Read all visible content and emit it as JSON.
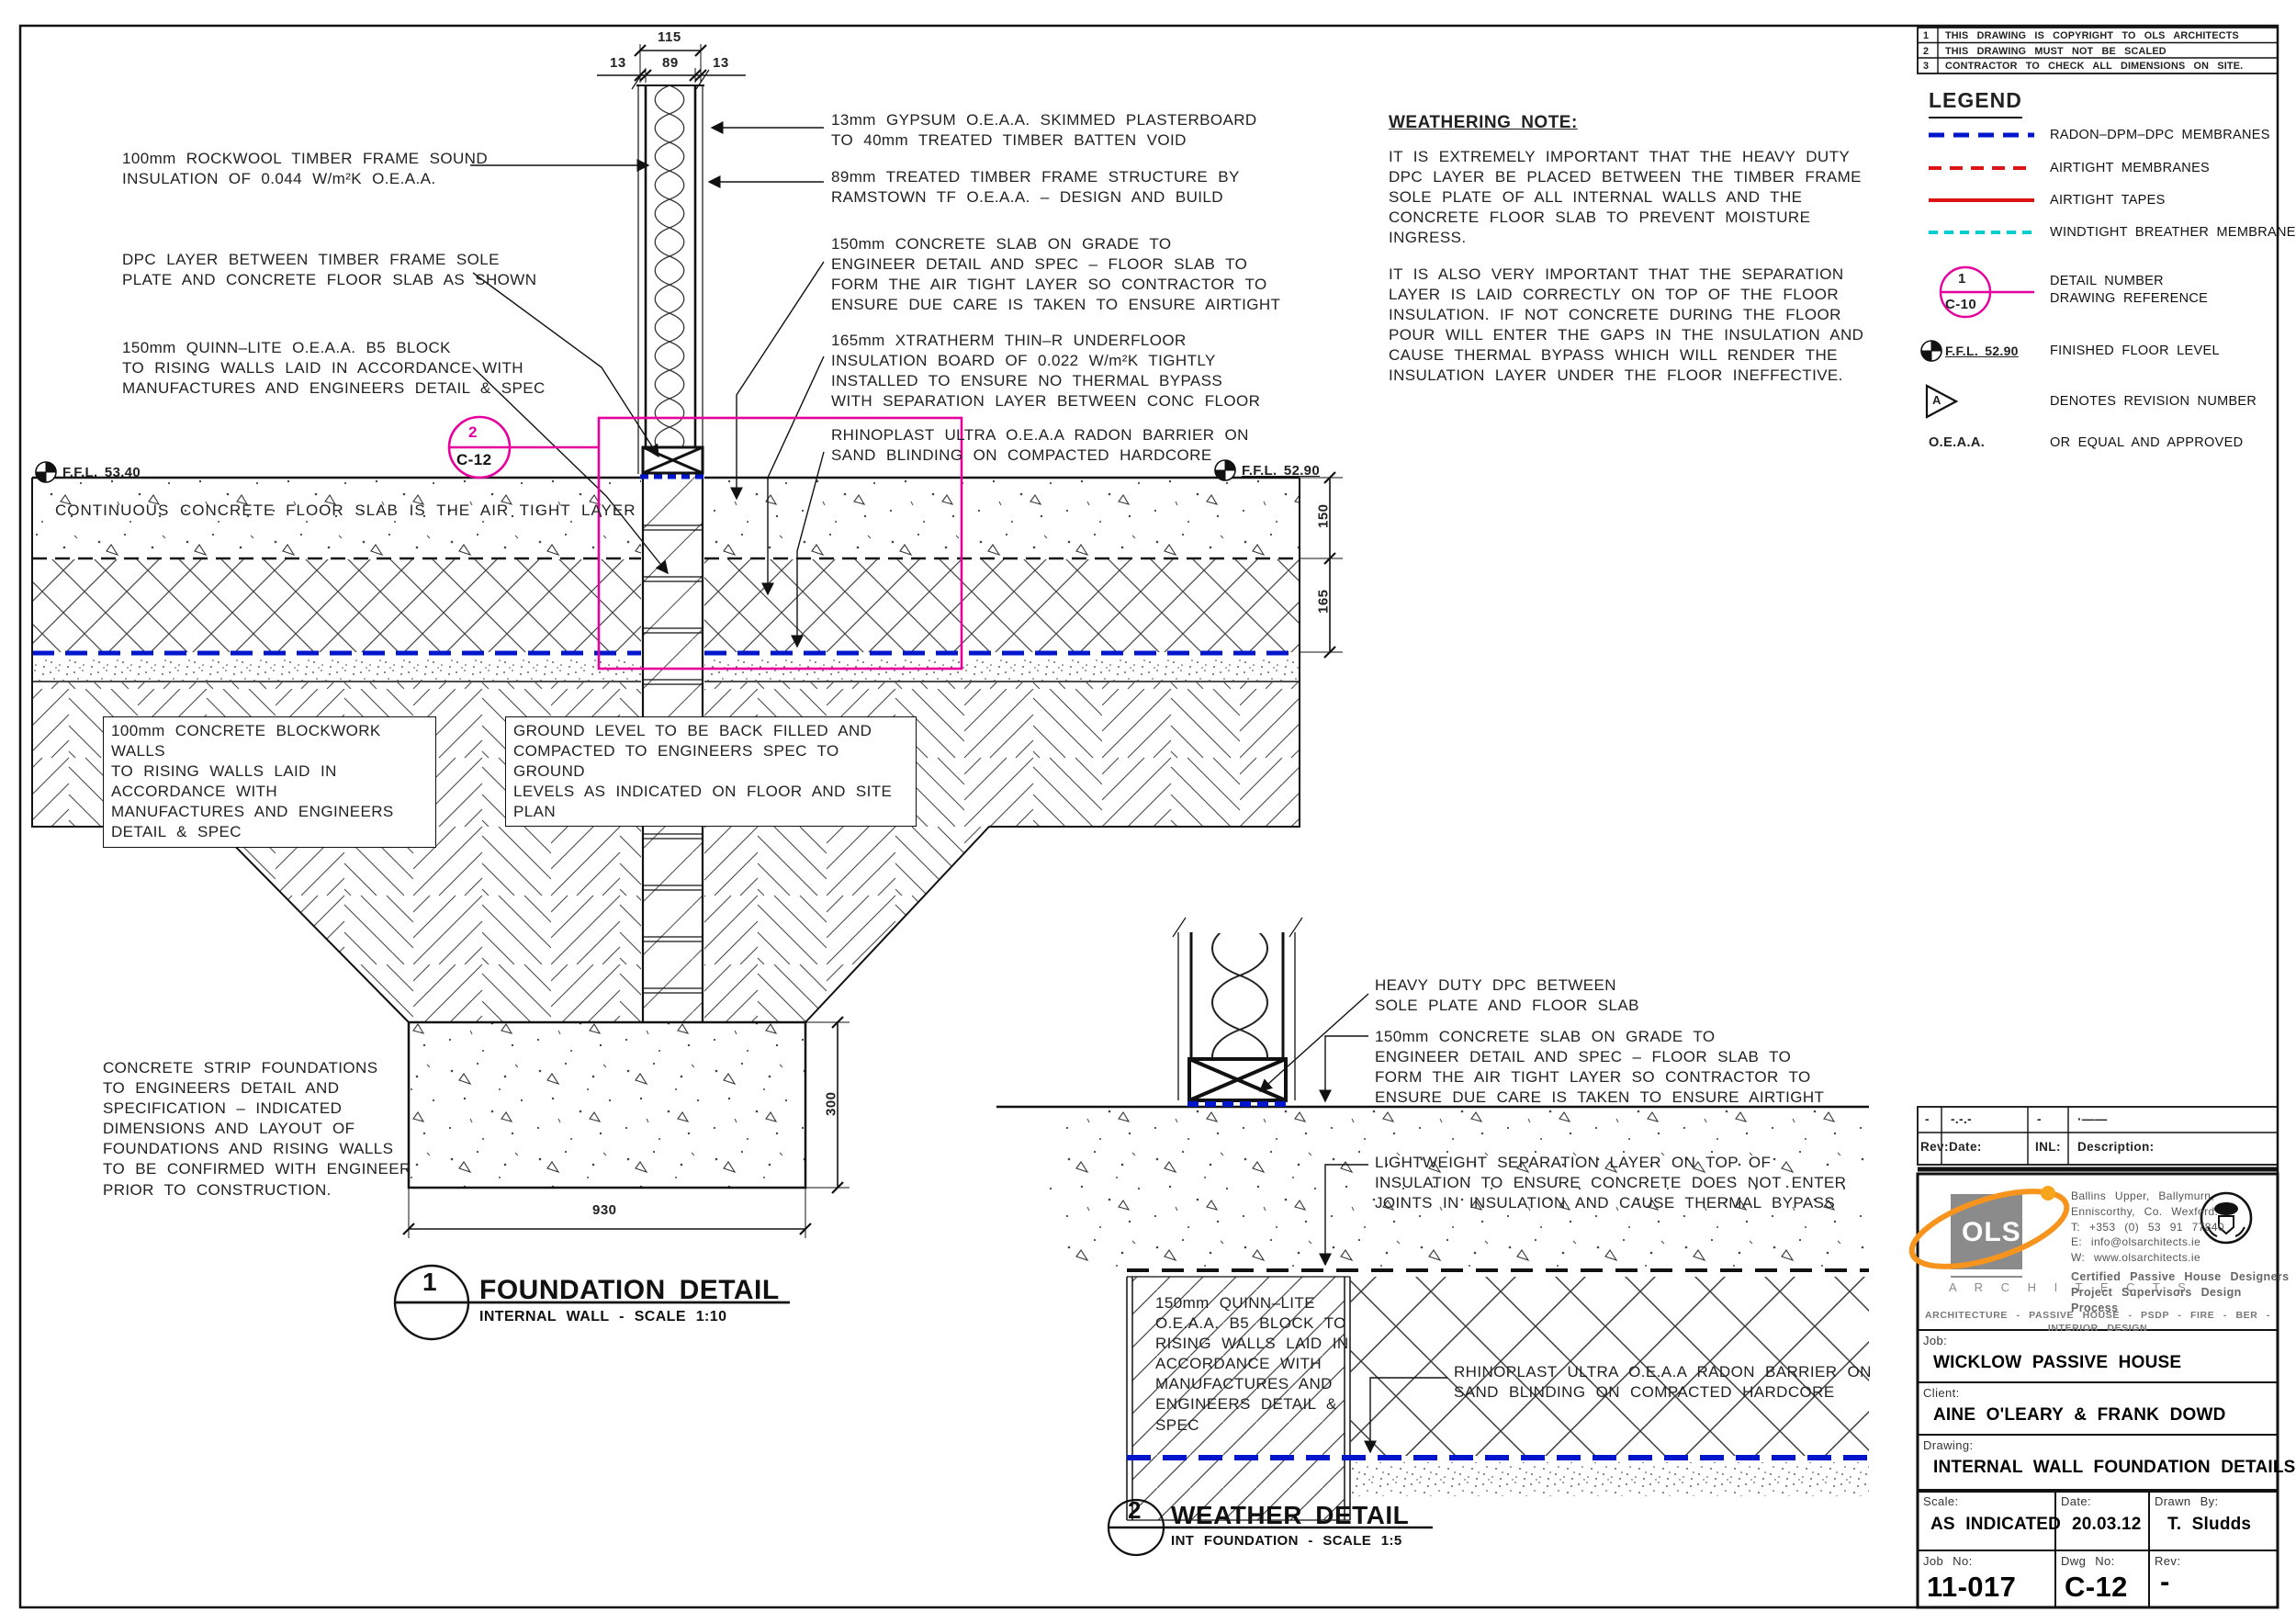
{
  "colors": {
    "magenta": "#e6009e",
    "radon_blue": "#0016cc",
    "airtight_red": "#dd1414",
    "windtight_cyan": "#00cfcf",
    "orange": "#f7941d",
    "line": "#1a1a1a"
  },
  "notes_table": {
    "rows": [
      {
        "num": "1",
        "text": "THIS DRAWING IS COPYRIGHT TO OLS ARCHITECTS"
      },
      {
        "num": "2",
        "text": "THIS DRAWING MUST NOT BE SCALED"
      },
      {
        "num": "3",
        "text": "CONTRACTOR TO CHECK ALL DIMENSIONS ON SITE."
      }
    ]
  },
  "legend": {
    "title": "LEGEND",
    "items": [
      {
        "label": "RADON–DPM–DPC  MEMBRANES"
      },
      {
        "label": "AIRTIGHT  MEMBRANES"
      },
      {
        "label": "AIRTIGHT  TAPES"
      },
      {
        "label": "WINDTIGHT  BREATHER  MEMBRANE"
      }
    ],
    "detail_symbol": {
      "number": "1",
      "ref": "C-10",
      "label": "DETAIL  NUMBER\nDRAWING  REFERENCE"
    },
    "ffl_symbol": {
      "text": "F.F.L.  52.90",
      "label": "FINISHED  FLOOR  LEVEL"
    },
    "revision_symbol": {
      "letter": "A",
      "label": "DENOTES  REVISION  NUMBER"
    },
    "oeaa": {
      "abbr": "O.E.A.A.",
      "label": "OR  EQUAL  AND  APPROVED"
    }
  },
  "weathering": {
    "title": "WEATHERING  NOTE:",
    "para1": "IT IS EXTREMELY IMPORTANT THAT THE HEAVY DUTY\nDPC LAYER BE PLACED BETWEEN THE TIMBER FRAME\nSOLE PLATE OF ALL INTERNAL WALLS AND THE\nCONCRETE FLOOR SLAB TO PREVENT MOISTURE\nINGRESS.",
    "para2": "IT IS ALSO VERY IMPORTANT THAT THE SEPARATION\nLAYER IS LAID CORRECTLY ON TOP OF THE FLOOR\nINSULATION. IF NOT CONCRETE DURING THE FLOOR\nPOUR WILL ENTER THE GAPS IN THE INSULATION AND\nCAUSE THERMAL BYPASS WHICH WILL RENDER THE\nINSULATION LAYER UNDER THE FLOOR INEFFECTIVE."
  },
  "detail1": {
    "callout_left_1": "100mm ROCKWOOL TIMBER FRAME SOUND\nINSULATION OF 0.044 W/m²K O.E.A.A.",
    "callout_left_2": "DPC LAYER BETWEEN TIMBER FRAME SOLE\nPLATE AND CONCRETE FLOOR SLAB AS SHOWN",
    "callout_left_3": "150mm QUINN–LITE O.E.A.A. B5 BLOCK\nTO RISING WALLS LAID IN ACCORDANCE WITH\nMANUFACTURES AND ENGINEERS DETAIL & SPEC",
    "callout_right_1": "13mm GYPSUM O.E.A.A. SKIMMED PLASTERBOARD\nTO 40mm TREATED TIMBER BATTEN VOID",
    "callout_right_2": "89mm TREATED TIMBER FRAME STRUCTURE BY\nRAMSTOWN TF O.E.A.A. – DESIGN AND BUILD",
    "callout_right_3": "150mm CONCRETE SLAB ON GRADE TO\nENGINEER DETAIL AND SPEC – FLOOR SLAB TO\nFORM THE AIR TIGHT LAYER SO CONTRACTOR TO\nENSURE DUE CARE IS TAKEN TO ENSURE AIRTIGHT",
    "callout_right_4": "165mm XTRATHERM THIN–R UNDERFLOOR\nINSULATION BOARD OF 0.022 W/m²K TIGHTLY\nINSTALLED TO ENSURE NO THERMAL BYPASS\nWITH SEPARATION LAYER BETWEEN CONC FLOOR",
    "callout_right_5": "RHINOPLAST ULTRA O.E.A.A RADON BARRIER ON\nSAND BLINDING ON COMPACTED HARDCORE",
    "slab_label": "CONTINUOUS  CONCRETE  FLOOR  SLAB  IS  THE  AIR  TIGHT  LAYER",
    "blockwork_label": "100mm CONCRETE BLOCKWORK WALLS\nTO RISING WALLS LAID IN ACCORDANCE WITH\nMANUFACTURES AND ENGINEERS DETAIL & SPEC",
    "ground_label": "GROUND LEVEL TO BE BACK FILLED AND\nCOMPACTED TO ENGINEERS SPEC TO GROUND\nLEVELS AS INDICATED ON FLOOR AND SITE PLAN",
    "strip_label": "CONCRETE STRIP FOUNDATIONS\nTO ENGINEERS DETAIL AND\nSPECIFICATION – INDICATED\nDIMENSIONS AND LAYOUT OF\nFOUNDATIONS AND RISING WALLS\nTO BE CONFIRMED WITH ENGINEER\nPRIOR TO CONSTRUCTION.",
    "ffl_left": "F.F.L.  53.40",
    "ffl_right": "F.F.L.  52.90",
    "marker": {
      "number": "2",
      "ref": "C-12"
    },
    "dims": {
      "overall": "115",
      "left": "13",
      "mid": "89",
      "right": "13",
      "slab": "150",
      "insulation": "165",
      "found_h": "300",
      "found_w": "930"
    },
    "title": {
      "number": "1",
      "name": "FOUNDATION DETAIL",
      "sub": "INTERNAL WALL - SCALE 1:10"
    }
  },
  "detail2": {
    "callout_1": "HEAVY DUTY DPC BETWEEN\nSOLE PLATE AND FLOOR SLAB",
    "callout_2": "150mm CONCRETE SLAB ON GRADE TO\nENGINEER DETAIL AND SPEC – FLOOR SLAB TO\nFORM THE AIR TIGHT LAYER SO CONTRACTOR TO\nENSURE DUE CARE IS TAKEN TO ENSURE AIRTIGHT",
    "callout_3": "LIGHTWEIGHT SEPARATION LAYER ON TOP OF\nINSULATION TO ENSURE CONCRETE DOES NOT ENTER\nJOINTS IN INSULATION AND CAUSE THERMAL BYPASS",
    "callout_4": "RHINOPLAST ULTRA O.E.A.A RADON BARRIER ON\nSAND BLINDING ON COMPACTED HARDCORE",
    "block_label": "150mm QUINN–LITE\nO.E.A.A. B5 BLOCK TO\nRISING WALLS LAID IN\nACCORDANCE WITH\nMANUFACTURES AND\nENGINEERS DETAIL &\nSPEC",
    "title": {
      "number": "2",
      "name": "WEATHER DETAIL",
      "sub": "INT FOUNDATION - SCALE 1:5"
    }
  },
  "revision_strip": {
    "cells": [
      "-",
      "-.-.-",
      "-",
      "·——"
    ],
    "headers": [
      "Rev:",
      "Date:",
      "INL:",
      "Description:"
    ]
  },
  "title_block": {
    "logo_text": "OLS",
    "logo_sub": "A R C H I T E C T S",
    "address": "Ballins Upper, Ballymurn,\nEnniscorthy, Co. Wexford.\nT: +353 (0) 53 91 77840\nE: info@olsarchitects.ie\nW: www.olsarchitects.ie",
    "cert": "Certified Passive House Designers\nProject Supervisors Design Process",
    "services": "ARCHITECTURE - PASSIVE HOUSE - PSDP - FIRE - BER - INTERIOR DESIGN",
    "job_label": "Job:",
    "job": "WICKLOW PASSIVE HOUSE",
    "client_label": "Client:",
    "client": "AINE O'LEARY & FRANK DOWD",
    "drawing_label": "Drawing:",
    "drawing": "INTERNAL WALL FOUNDATION DETAILS",
    "scale_label": "Scale:",
    "scale": "AS INDICATED",
    "date_label": "Date:",
    "date": "20.03.12",
    "drawn_label": "Drawn By:",
    "drawn": "T. Sludds",
    "jobno_label": "Job No:",
    "jobno": "11-017",
    "dwgno_label": "Dwg No:",
    "dwgno": "C-12",
    "rev_label": "Rev:",
    "rev": "-"
  }
}
